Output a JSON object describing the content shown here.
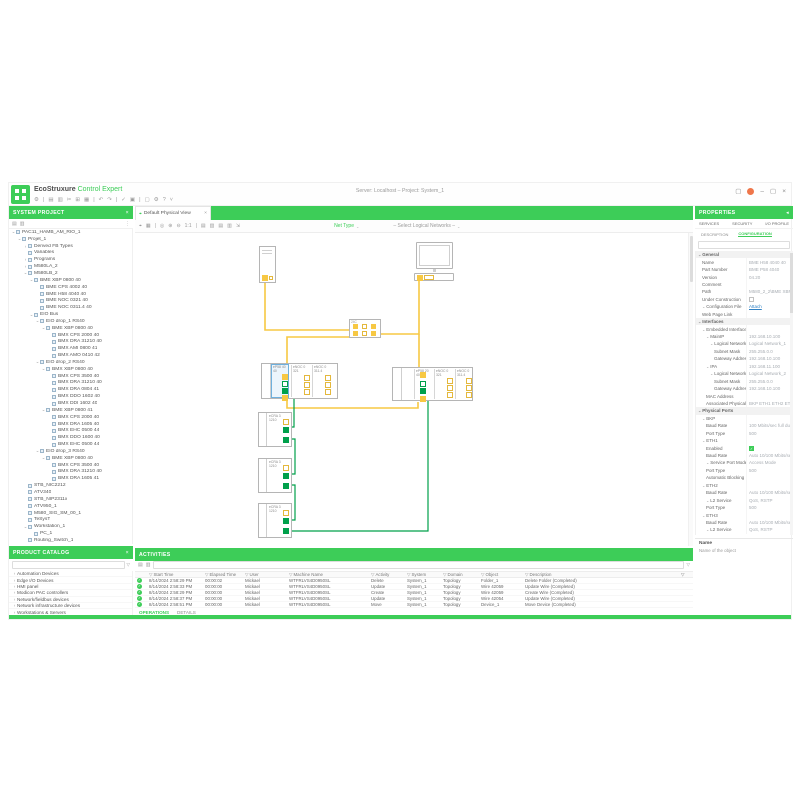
{
  "window": {
    "brand_prefix": "EcoStruxure",
    "brand_suffix": "Control Expert",
    "doc_title": "Server: Localhost – Project: System_1",
    "controls": {
      "layout": "▢",
      "minimize": "–",
      "maximize": "▢",
      "close": "×"
    }
  },
  "top_toolbar": {
    "icons": [
      "⚙",
      "|",
      "▤",
      "▥",
      "✂",
      "⊞",
      "▦",
      "|",
      "↶",
      "↷",
      "|",
      "✓",
      "▣",
      "|",
      "▢",
      "⚙",
      "?",
      "˅"
    ]
  },
  "left": {
    "project_header": "SYSTEM PROJECT",
    "close_icon": "×",
    "tool_icons": [
      "▤",
      "▥"
    ],
    "tool_icon_right": "⋮",
    "tree": [
      [
        0,
        "v",
        "PAC11_HAMB_AM_RIO_1"
      ],
      [
        1,
        "v",
        "Projet_1"
      ],
      [
        2,
        ">",
        "Derived FB Types"
      ],
      [
        2,
        "",
        "Variables"
      ],
      [
        2,
        ">",
        "Programs"
      ],
      [
        2,
        ">",
        "M580LA_2"
      ],
      [
        2,
        "v",
        "M580LB_2"
      ],
      [
        3,
        "v",
        "BME XBP 0800 40"
      ],
      [
        4,
        "",
        "BME CPS 4002 40"
      ],
      [
        4,
        "",
        "BME H58 4040 40"
      ],
      [
        4,
        "",
        "BME NOC 0321 40"
      ],
      [
        4,
        "",
        "BME NOC 0311.4 40"
      ],
      [
        3,
        "v",
        "EIO Bus"
      ],
      [
        4,
        "v",
        "EIO drop_1 RS40"
      ],
      [
        5,
        "v",
        "BME XBP 0800 40"
      ],
      [
        6,
        "",
        "BMX CPS 2000 40"
      ],
      [
        6,
        "",
        "BMX DRA 31210 40"
      ],
      [
        6,
        "",
        "BMX AMI 0800 41"
      ],
      [
        6,
        "",
        "BMX AMO 0410 42"
      ],
      [
        4,
        "v",
        "EIO drop_2 RS40"
      ],
      [
        5,
        "v",
        "BMX XBP 0800 40"
      ],
      [
        6,
        "",
        "BMX CPS 3500 40"
      ],
      [
        6,
        "",
        "BMX DRA 31210 40"
      ],
      [
        6,
        "",
        "BMX DRA 0804 41"
      ],
      [
        6,
        "",
        "BMX DDO 1602 40"
      ],
      [
        6,
        "",
        "BMX DDI 1602 40"
      ],
      [
        5,
        "v",
        "BME XBP 0800 41"
      ],
      [
        6,
        "",
        "BMX CPS 2000 40"
      ],
      [
        6,
        "",
        "BMX DRA 1605 40"
      ],
      [
        6,
        "",
        "BMX EHC 0500 44"
      ],
      [
        6,
        "",
        "BMX DDO 1600 40"
      ],
      [
        6,
        "",
        "BMX EHC 0500 44"
      ],
      [
        4,
        "v",
        "EIO drop_3 RS40"
      ],
      [
        5,
        "v",
        "BME XBP 0800 40"
      ],
      [
        6,
        "",
        "BMX CPS 3500 40"
      ],
      [
        6,
        "",
        "BMX DRA 31210 40"
      ],
      [
        6,
        "",
        "BMX DRA 1605 41"
      ],
      [
        2,
        "",
        "STB_NIC2212"
      ],
      [
        2,
        "",
        "ATV340"
      ],
      [
        2,
        "",
        "STB_NIP2311x"
      ],
      [
        2,
        "",
        "ATV950_1"
      ],
      [
        2,
        "",
        "M580_SIG_SM_00_1"
      ],
      [
        2,
        "",
        "TeSysT"
      ],
      [
        2,
        "v",
        "Workstation_1"
      ],
      [
        3,
        "",
        "PC_1"
      ],
      [
        2,
        "",
        "Routing_Switch_1"
      ]
    ],
    "catalog_header": "PRODUCT CATALOG",
    "catalog_items": [
      "Automation Devices",
      "Edge I/O Devices",
      "HMI panel",
      "Modicon PAC controllers",
      "Network/fieldbus devices",
      "Network infrastructure devices",
      "Workstations & Servers"
    ]
  },
  "center": {
    "tab_label": "Default Physical View",
    "tab_close": "×",
    "toolbar_icons": [
      "⌖",
      "▦",
      "|",
      "◎",
      "⊕",
      "⊖",
      "1:1",
      "|",
      "▤",
      "▥",
      "▤",
      "▥",
      "⇲"
    ],
    "net_type_label": "Net Type",
    "networks_placeholder": "– Select Logical Networks –",
    "diagram": {
      "switch_label": "24C",
      "left_rack_modules": [
        "eP58 4040",
        "eNOC 0321",
        "eNOC 0311.4"
      ],
      "right_rack_modules": [
        "eP58 2040",
        "eNOC 0321",
        "eNOC 0311.4"
      ],
      "drops": [
        "eCRA 31210",
        "eCRA 31210",
        "eCRA 31210"
      ]
    },
    "activities": {
      "header": "ACTIVITIES",
      "columns": [
        "Start Time",
        "Elapsed Time",
        "User",
        "Machine Name",
        "Activity",
        "System",
        "Domain",
        "Object",
        "Description"
      ],
      "rows": [
        [
          "8/14/2024 2:58:29 PM",
          "00:00:02",
          "Mickael",
          "WTFRLVS4D0950SL",
          "Delete",
          "System_1",
          "Topology",
          "Folder_1",
          "Delete Folder (Completed)"
        ],
        [
          "8/14/2024 2:58:33 PM",
          "00:00:00",
          "Mickael",
          "WTFRLVS4D0950SL",
          "Update",
          "System_1",
          "Topology",
          "Wire 42059",
          "Update Wire (Completed)"
        ],
        [
          "8/14/2024 2:58:29 PM",
          "00:00:00",
          "Mickael",
          "WTFRLVS4D0950SL",
          "Create",
          "System_1",
          "Topology",
          "Wire 42059",
          "Create Wire (Completed)"
        ],
        [
          "8/14/2024 2:58:37 PM",
          "00:00:00",
          "Mickael",
          "WTFRLVS4D0950SL",
          "Update",
          "System_1",
          "Topology",
          "Wire 42054",
          "Update Wire (Completed)"
        ],
        [
          "8/14/2024 2:58:51 PM",
          "00:00:00",
          "Mickael",
          "WTFRLVS4D0950SL",
          "Move",
          "System_1",
          "Topology",
          "Device_1",
          "Move Device (Completed)"
        ]
      ],
      "tabs": [
        "OPERATIONS",
        "DETAILS"
      ],
      "active_tab": 0
    }
  },
  "right": {
    "header": "PROPERTIES",
    "pin_icon": "◂",
    "tabs_top": [
      "SERVICES",
      "SECURITY",
      "I/O PROFILE"
    ],
    "tabs_sub": [
      "DESCRIPTION",
      "CONFIGURATION"
    ],
    "active_sub": 1,
    "rows": [
      [
        0,
        1,
        "General",
        "",
        "sec"
      ],
      [
        1,
        0,
        "Name",
        "BME H58 4040 40",
        "f"
      ],
      [
        1,
        0,
        "Part Number",
        "BME P58 4040",
        "f"
      ],
      [
        1,
        0,
        "Version",
        "04.20",
        "f"
      ],
      [
        1,
        0,
        "Comment",
        "",
        "f"
      ],
      [
        1,
        0,
        "Path",
        "M580_2_2\\BME XBP 0800",
        "f"
      ],
      [
        1,
        0,
        "Under Construction",
        "",
        "chk0"
      ],
      [
        1,
        1,
        "Configuration File",
        "Attach",
        "link"
      ],
      [
        1,
        0,
        "Web Page Link",
        "",
        "f"
      ],
      [
        0,
        1,
        "Interfaces",
        "",
        "sec"
      ],
      [
        1,
        1,
        "Embedded Interface",
        "",
        "sub"
      ],
      [
        2,
        1,
        "MainIP",
        "192.168.10.100",
        "f"
      ],
      [
        3,
        1,
        "Logical Network",
        "Logical Network_1",
        "dd"
      ],
      [
        4,
        0,
        "Subnet Mask",
        "255.255.0.0",
        "f"
      ],
      [
        4,
        0,
        "Gateway Address",
        "192.168.10.100",
        "f"
      ],
      [
        2,
        1,
        "IPA",
        "192.168.11.100",
        "f"
      ],
      [
        3,
        1,
        "Logical Network",
        "Logical Network_2",
        "dd"
      ],
      [
        4,
        0,
        "Subnet Mask",
        "255.255.0.0",
        "f"
      ],
      [
        4,
        0,
        "Gateway Address",
        "192.168.10.100",
        "f"
      ],
      [
        2,
        0,
        "MAC Address",
        "",
        "f"
      ],
      [
        2,
        0,
        "Associated Physical Ports",
        "BKP ETH1 ETH2 ETH3",
        "f"
      ],
      [
        0,
        1,
        "Physical Ports",
        "",
        "sec"
      ],
      [
        1,
        1,
        "BKP",
        "",
        "sub"
      ],
      [
        2,
        0,
        "Baud Rate",
        "100 Mbits/sec full duplex",
        "f"
      ],
      [
        2,
        0,
        "Port Type",
        "500",
        "f"
      ],
      [
        1,
        1,
        "ETH1",
        "",
        "sub"
      ],
      [
        2,
        0,
        "Enabled",
        "",
        "chk1"
      ],
      [
        2,
        0,
        "Baud Rate",
        "Auto 10/100 Mbits/sec",
        "f"
      ],
      [
        2,
        1,
        "Service Port Mode",
        "Access Mode",
        "dd"
      ],
      [
        2,
        0,
        "Port Type",
        "500",
        "f"
      ],
      [
        2,
        0,
        "Automatic Blocking",
        "",
        "f"
      ],
      [
        1,
        1,
        "ETH2",
        "",
        "sub"
      ],
      [
        2,
        0,
        "Baud Rate",
        "Auto 10/100 Mbits/sec",
        "f"
      ],
      [
        2,
        1,
        "L2 Service",
        "QoS, RSTP",
        "dd"
      ],
      [
        2,
        0,
        "Port Type",
        "500",
        "f"
      ],
      [
        1,
        1,
        "ETH3",
        "",
        "sub"
      ],
      [
        2,
        0,
        "Baud Rate",
        "Auto 10/100 Mbits/sec",
        "f"
      ],
      [
        2,
        1,
        "L2 Service",
        "QoS, RSTP",
        "dd"
      ]
    ],
    "footer_title": "Name",
    "footer_desc": "Name of the object"
  }
}
